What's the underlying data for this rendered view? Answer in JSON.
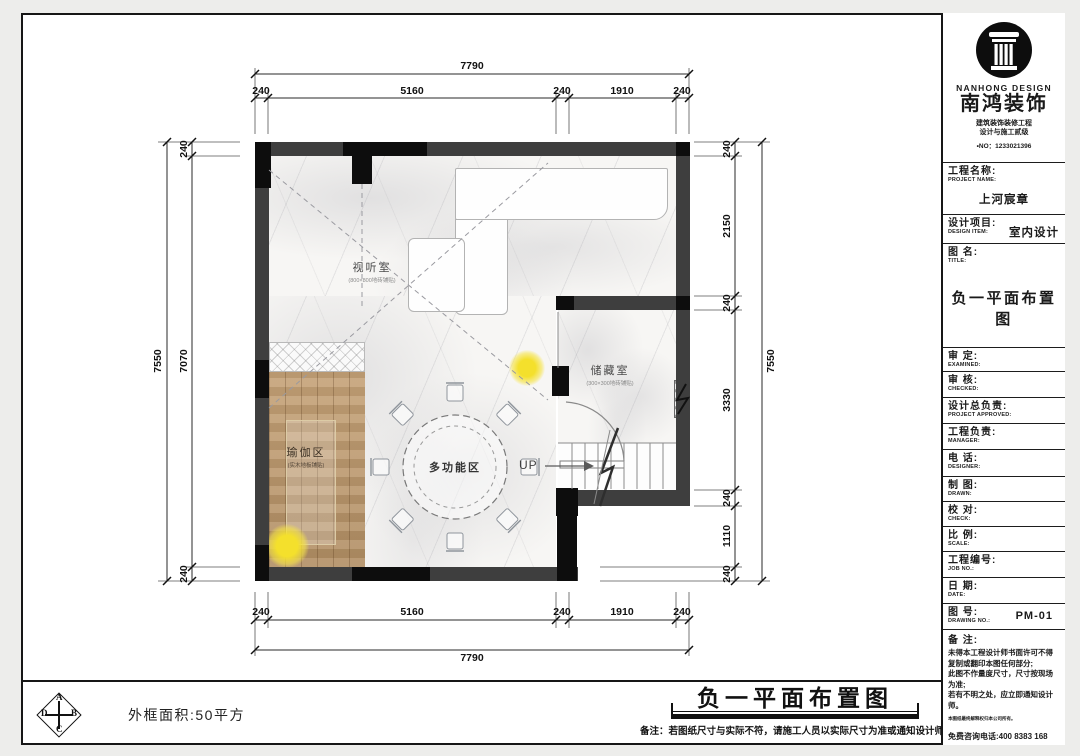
{
  "palette": {
    "wall_dark": "#3e3e3e",
    "wall_black": "#0d0d0d",
    "wood": "#c09a6c",
    "accent_light": "#f4e02c"
  },
  "plan": {
    "rooms": {
      "av": {
        "name": "视听室",
        "sub": "(800×800地砖铺贴)"
      },
      "yoga": {
        "name": "瑜伽区",
        "sub": "(实木地板铺贴)"
      },
      "multi": {
        "name": "多功能区"
      },
      "storage": {
        "name": "储藏室",
        "sub": "(300×300地砖铺贴)"
      },
      "stairs": {
        "label": "UP"
      }
    },
    "dims": {
      "top_total": "7790",
      "top_segments": [
        "240",
        "5160",
        "240",
        "1910",
        "240"
      ],
      "bottom_segments": [
        "240",
        "5160",
        "240",
        "1910",
        "240"
      ],
      "bottom_total": "7790",
      "left_total": "7550",
      "left_segments": [
        "240",
        "7070",
        "240"
      ],
      "right_total": "7550",
      "right_segments": [
        "240",
        "2150",
        "240",
        "3330",
        "240",
        "1110",
        "240"
      ]
    }
  },
  "titleblock": {
    "brand": {
      "en": "NANHONG DESIGN",
      "cn": "南鸿装饰",
      "line1": "建筑装饰装修工程",
      "line2": "设计与施工贰级",
      "reg": "•NO：1233021396"
    },
    "fields": [
      {
        "label": "工程名称:",
        "sub": "PROJECT NAME:",
        "value": "上河宸章"
      },
      {
        "label": "设计项目:",
        "sub": "DESIGN ITEM:",
        "value": "室内设计"
      },
      {
        "label": "图 名:",
        "sub": "TITLE:",
        "value": "负一平面布置图"
      },
      {
        "label": "审  定:",
        "sub": "EXAMINED:",
        "value": ""
      },
      {
        "label": "审  核:",
        "sub": "CHECKED:",
        "value": ""
      },
      {
        "label": "设计总负责:",
        "sub": "PROJECT APPROVED:",
        "value": ""
      },
      {
        "label": "工程负责:",
        "sub": "MANAGER:",
        "value": ""
      },
      {
        "label": "电  话:",
        "sub": "DESIGNER:",
        "value": ""
      },
      {
        "label": "制  图:",
        "sub": "DRAWN:",
        "value": ""
      },
      {
        "label": "校  对:",
        "sub": "CHECK:",
        "value": ""
      },
      {
        "label": "比  例:",
        "sub": "SCALE:",
        "value": ""
      },
      {
        "label": "工程编号:",
        "sub": "JOB  NO.:",
        "value": ""
      },
      {
        "label": "日  期:",
        "sub": "DATE:",
        "value": ""
      },
      {
        "label": "图  号:",
        "sub": "DRAWING NO.:",
        "value": "PM-01"
      }
    ],
    "notes": {
      "label": "备 注:",
      "lines": [
        "未得本工程设计师书面许可不得",
        "复制或翻印本图任何部分;",
        "此图不作量度尺寸，尺寸按现场",
        "为准;",
        "若有不明之处，应立即通知设计",
        "师。"
      ],
      "fine_print": "本图纸最终解释权归本公司所有。",
      "hotline": "免费咨询电话:400 8383 168"
    }
  },
  "footer": {
    "area_label": "外框面积:50平方",
    "bottom_title": "负一平面布置图",
    "bottom_note": "备注：若图纸尺寸与实际不符，请施工人员以实际尺寸为准或通知设计师,否则承担相应责任！",
    "stamp_letters": [
      "A",
      "B",
      "C",
      "D"
    ]
  }
}
